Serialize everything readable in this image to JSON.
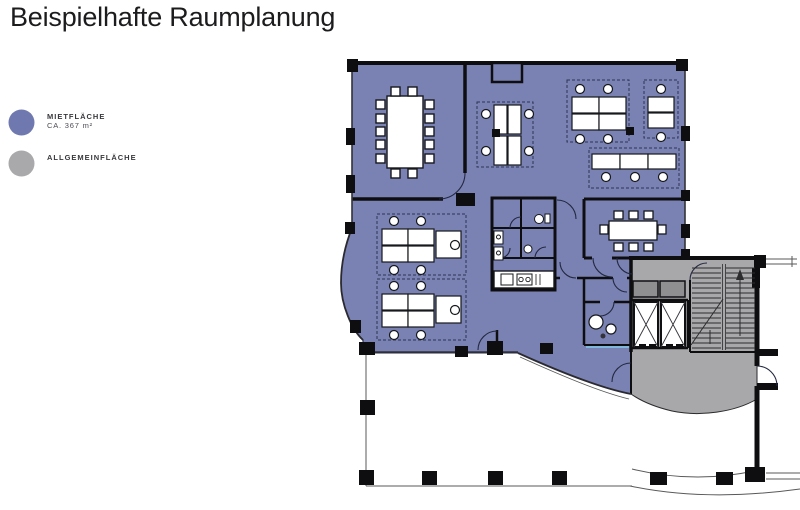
{
  "page": {
    "title": "Beispielhafte Raumplanung"
  },
  "legend": {
    "items": [
      {
        "id": "mietflaeche",
        "label": "MIETFLÄCHE",
        "sublabel": "CA. 367 m²",
        "color": "#6F79B0"
      },
      {
        "id": "allgemeinflaeche",
        "label": "ALLGEMEINFLÄCHE",
        "sublabel": "",
        "color": "#A9A9AB"
      }
    ]
  },
  "floorplan": {
    "rental_area_color": "#7A82B4",
    "common_area_color": "#A8A8AA",
    "wall_color": "#0E0E10",
    "glazing_accent_color": "#7FB7DD",
    "shaft_box_color": "#8F8F92"
  }
}
